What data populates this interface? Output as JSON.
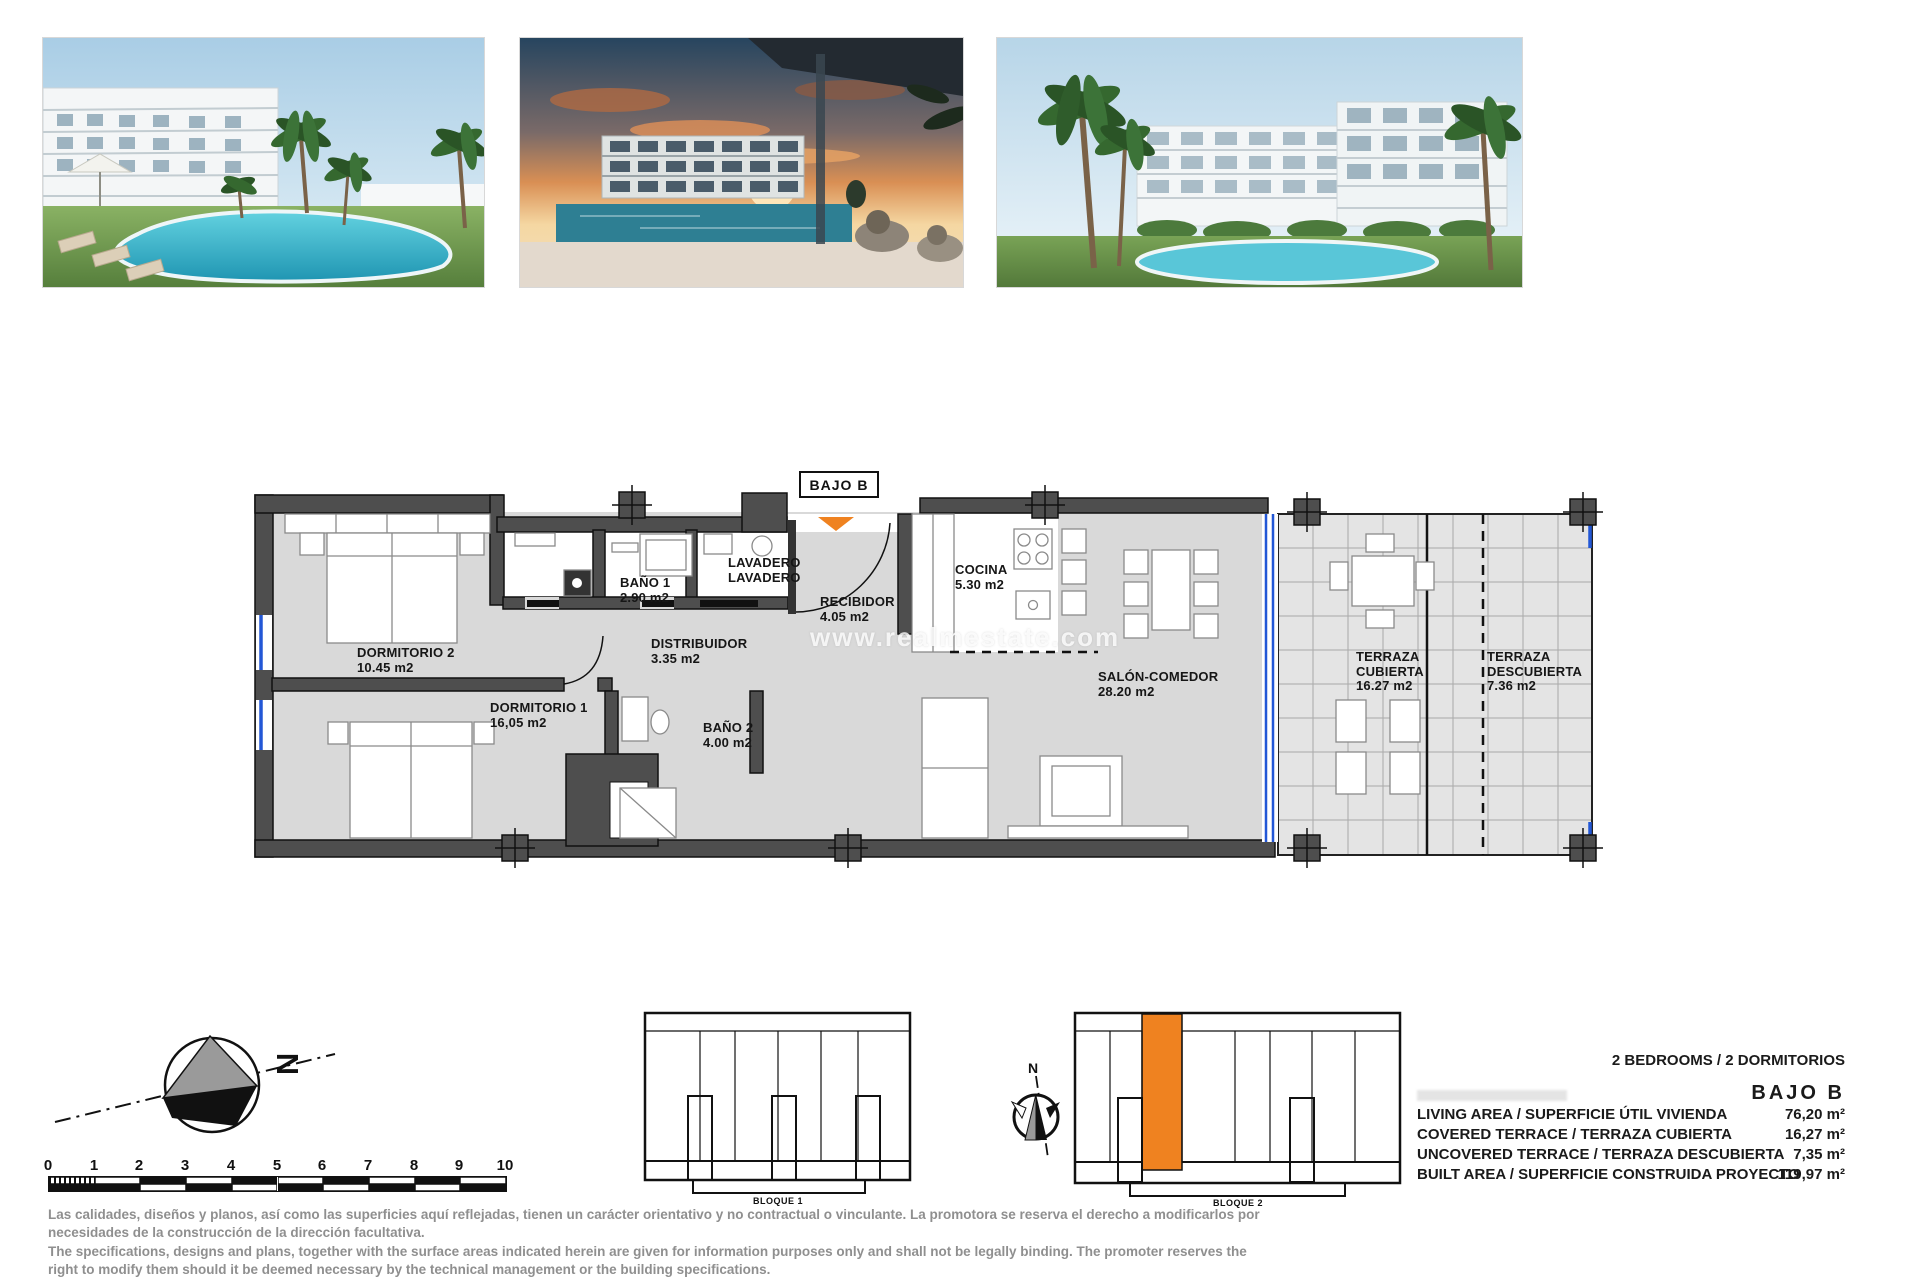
{
  "colors": {
    "wall": "#4e4e4e",
    "floor": "#d9d9d9",
    "accent_orange": "#ef8220",
    "glazing_blue": "#2257d6",
    "disclaimer_gray": "#8f8f8f"
  },
  "photos": [
    {
      "name": "pool-garden-render"
    },
    {
      "name": "sunset-terrace-render"
    },
    {
      "name": "buildings-palms-render"
    }
  ],
  "plan": {
    "unit_box": "BAJO B",
    "watermark": "www.realmestate.com",
    "rooms": [
      {
        "id": "dormitorio-2",
        "label": "DORMITORIO 2",
        "area": "10.45 m2"
      },
      {
        "id": "dormitorio-1",
        "label": "DORMITORIO 1",
        "area": "16,05 m2"
      },
      {
        "id": "bano-1",
        "label": "BAÑO 1",
        "area": "2.90 m2"
      },
      {
        "id": "bano-2",
        "label": "BAÑO 2",
        "area": "4.00 m2"
      },
      {
        "id": "lavadero",
        "label": "LAVADERO",
        "area": "LAVADERO"
      },
      {
        "id": "distribuidor",
        "label": "DISTRIBUIDOR",
        "area": "3.35 m2"
      },
      {
        "id": "recibidor",
        "label": "RECIBIDOR",
        "area": "4.05 m2"
      },
      {
        "id": "cocina",
        "label": "COCINA",
        "area": "5.30 m2"
      },
      {
        "id": "salon-comedor",
        "label": "SALÓN-COMEDOR",
        "area": "28.20 m2"
      },
      {
        "id": "terraza-cubierta",
        "label": "TERRAZA CUBIERTA",
        "area": "16.27 m2"
      },
      {
        "id": "terraza-descubierta",
        "label": "TERRAZA DESCUBIERTA",
        "area": "7.36 m2"
      }
    ]
  },
  "compass": {
    "big_label": "N",
    "small_label": "N"
  },
  "scale_bar": {
    "ticks": [
      "0",
      "1",
      "2",
      "3",
      "4",
      "5",
      "6",
      "7",
      "8",
      "9",
      "10"
    ]
  },
  "blocks": {
    "block1": "BLOQUE 1",
    "block2": "BLOQUE 2"
  },
  "specs": {
    "bedrooms": "2 BEDROOMS / 2 DORMITORIOS",
    "unit": "BAJO B",
    "rows": [
      {
        "label": "LIVING AREA / SUPERFICIE ÚTIL VIVIENDA",
        "value": "76,20 m²"
      },
      {
        "label": "COVERED TERRACE / TERRAZA CUBIERTA",
        "value": "16,27 m²"
      },
      {
        "label": "UNCOVERED TERRACE / TERRAZA DESCUBIERTA",
        "value": "7,35 m²"
      },
      {
        "label": "BUILT AREA / SUPERFICIE CONSTRUIDA PROYECTO",
        "value": "119,97 m²"
      }
    ]
  },
  "disclaimer": {
    "lines": [
      "Las calidades, diseños y planos, así como las superficies aquí reflejadas, tienen un carácter orientativo y no contractual o vinculante. La promotora se reserva el derecho a modificarlos por",
      "necesidades de la construcción de la dirección facultativa.",
      "The specifications, designs and plans, together with the surface areas indicated herein are given for information purposes only and shall not be legally binding. The promoter reserves the",
      "right to modify them should it be deemed necessary by the technical management or the building specifications."
    ]
  }
}
